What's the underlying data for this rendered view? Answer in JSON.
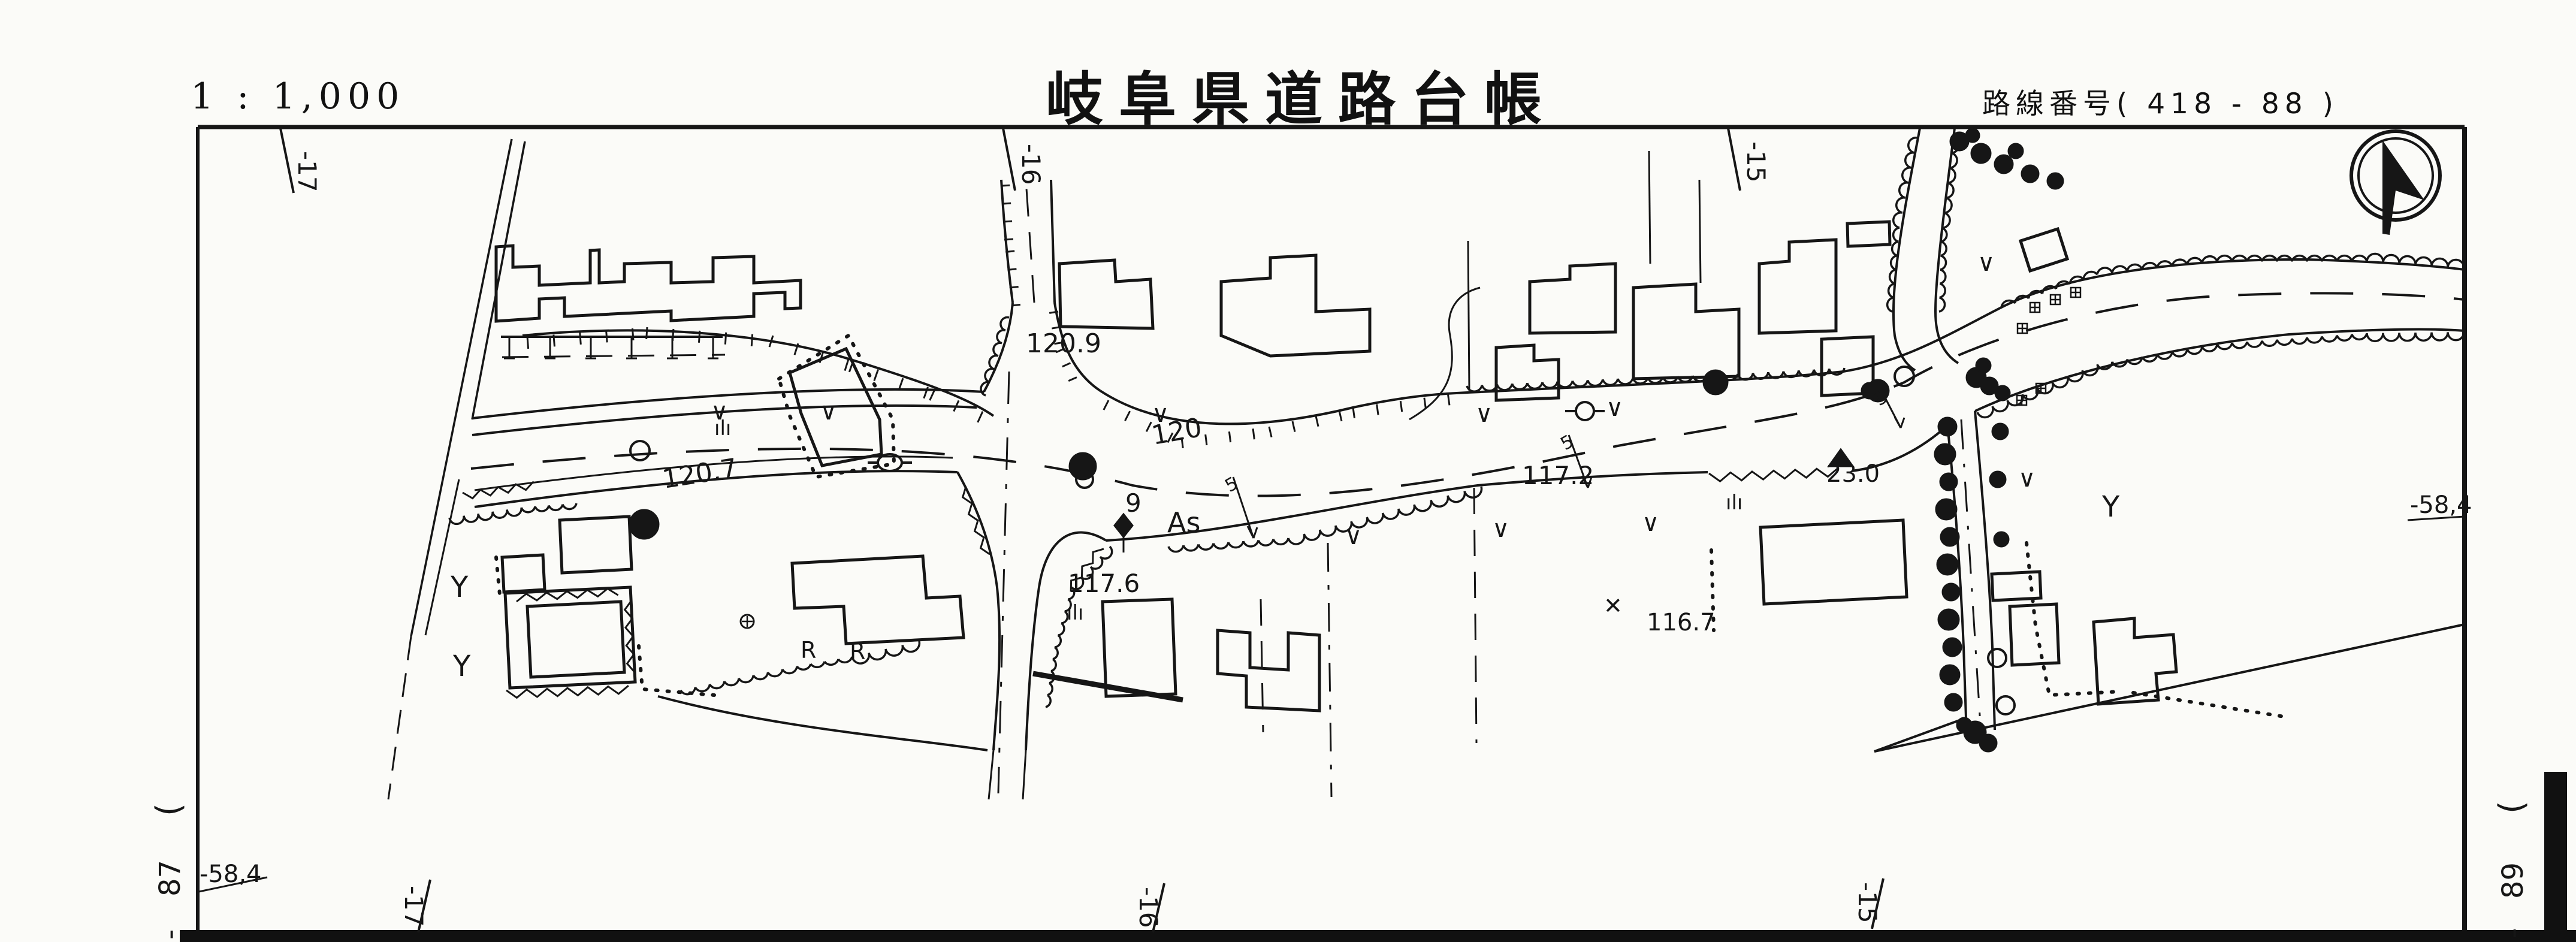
{
  "header": {
    "scale": "1 : 1,000",
    "title": "岐阜県道路台帳",
    "route": "路線番号( 418 - 88 )"
  },
  "grid": {
    "top_ticks": [
      "-17",
      "-16",
      "-15"
    ],
    "bottom_ticks": [
      "-17",
      "-16",
      "-15"
    ],
    "right_elevation": "-58,4",
    "left_elevation": "-58,4"
  },
  "sheet_refs": {
    "left": {
      "paren": "(",
      "number": "87",
      "dash": "-"
    },
    "right": {
      "paren": "(",
      "number": "89",
      "dash": "-"
    }
  },
  "map": {
    "labels": [
      {
        "text": "120.9"
      },
      {
        "text": "120"
      },
      {
        "text": "120.7"
      },
      {
        "text": "117.2"
      },
      {
        "text": "23.0"
      },
      {
        "text": "9"
      },
      {
        "text": "As"
      },
      {
        "text": "117.6"
      },
      {
        "text": "116.7"
      },
      {
        "text": "R"
      },
      {
        "text": "R"
      },
      {
        "text": "Y"
      },
      {
        "text": "Y"
      },
      {
        "text": "Y"
      },
      {
        "text": "✕"
      },
      {
        "text": "ılı"
      },
      {
        "text": "ılı"
      },
      {
        "text": "ılı"
      },
      {
        "text": "∨"
      },
      {
        "text": "∨"
      },
      {
        "text": "∨"
      },
      {
        "text": "∨"
      },
      {
        "text": "∨"
      },
      {
        "text": "∨"
      },
      {
        "text": "∨"
      },
      {
        "text": "∨"
      },
      {
        "text": "∨"
      },
      {
        "text": "∨"
      },
      {
        "text": "5"
      },
      {
        "text": "5"
      },
      {
        "text": "5"
      }
    ],
    "colors": {
      "ink": "#161616",
      "paper": "#fbfbf8"
    }
  }
}
